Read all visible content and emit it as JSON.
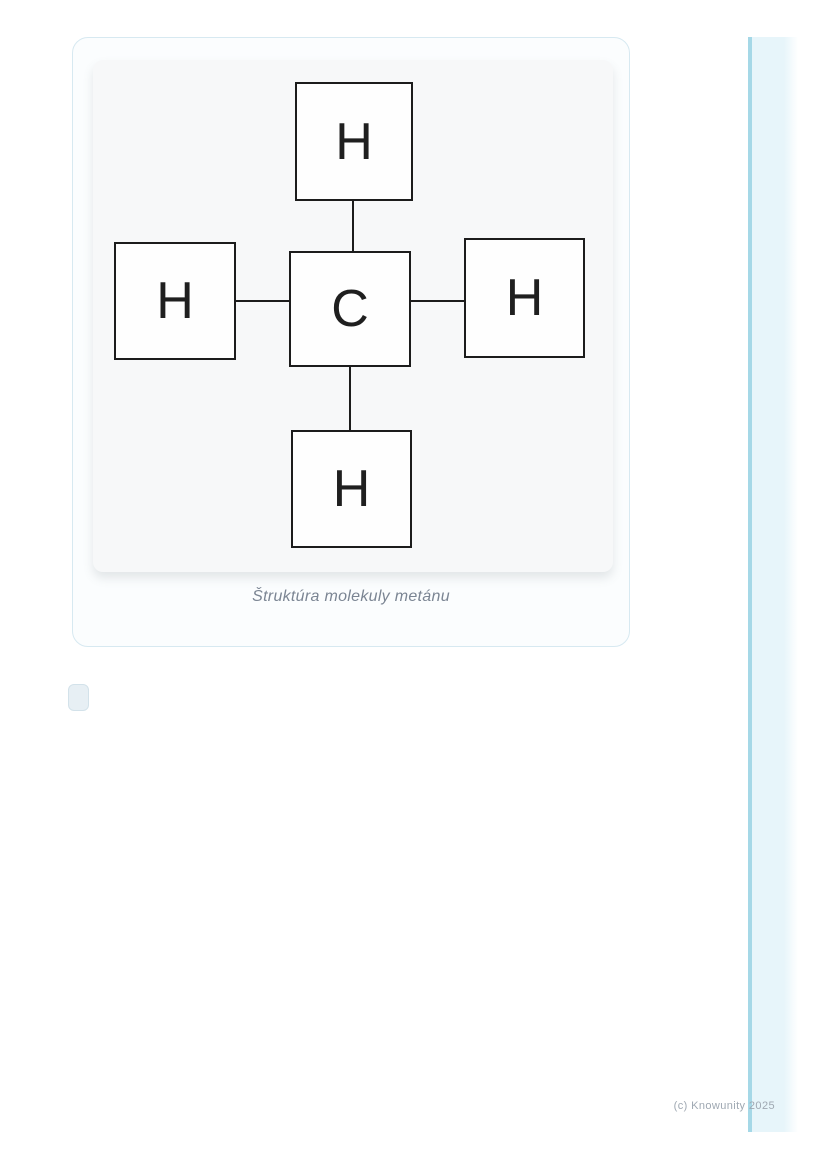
{
  "page": {
    "copyright": "(c) Knowunity 2025"
  },
  "figure": {
    "caption": "Štruktúra molekuly metánu",
    "molecule": {
      "name": "methane",
      "center_atom": "C",
      "top_atom": "H",
      "left_atom": "H",
      "right_atom": "H",
      "bottom_atom": "H",
      "bond_count": 4
    }
  },
  "colors": {
    "card_border": "#d7e9f1",
    "card_bg": "#fbfdfe",
    "panel_bg": "#f7f8f9",
    "box_border": "#1c1c1c",
    "box_bg": "#fefefe",
    "bond_color": "#1c1c1c",
    "atom_text": "#1f1f1f",
    "caption_text": "#7b8593",
    "sidebar_edge": "#a5d8e7",
    "sidebar_fill": "#e7f5fa",
    "copyright_text": "#9fa8b2",
    "checkbox_bg": "#e7eff4",
    "checkbox_border": "#d3e2ea"
  }
}
